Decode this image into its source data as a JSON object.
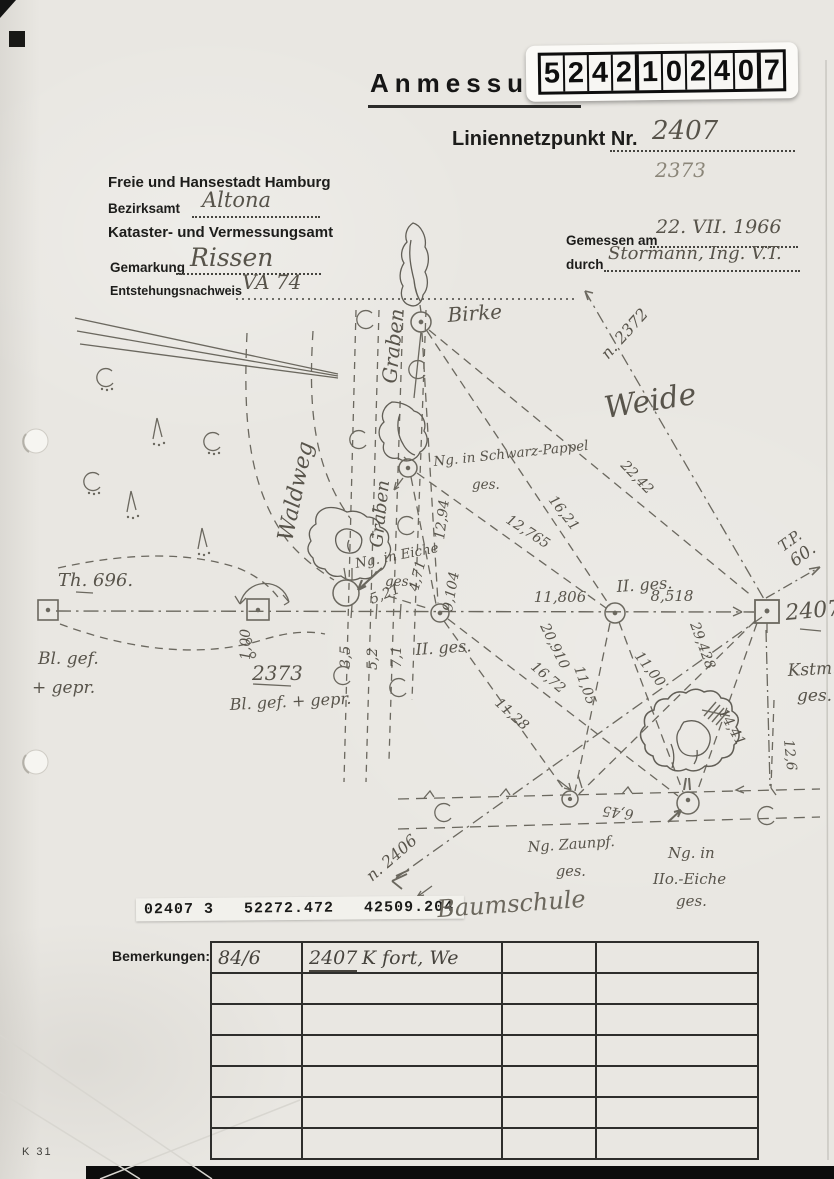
{
  "stamp": {
    "digits": [
      "5",
      "2",
      "4",
      "2",
      "1",
      "0",
      "2",
      "4",
      "0",
      "7"
    ]
  },
  "header": {
    "title": "Anmessung",
    "point_label": "Liniennetzpunkt Nr.",
    "point_number": "2407",
    "point_number_alt": "2373",
    "agency_line1": "Freie und Hansestadt Hamburg",
    "bezirksamt_label": "Bezirksamt",
    "bezirksamt_value": "Altona",
    "agency_line2": "Kataster- und Vermessungsamt",
    "gemarkung_label": "Gemarkung",
    "gemarkung_value": "Rissen",
    "entstehung_label": "Entstehungsnachweis",
    "entstehung_value": "VA 74",
    "gemessen_label": "Gemessen am",
    "gemessen_value": "22. VII. 1966",
    "durch_label": "durch",
    "durch_value": "Stormann, Ing. V.T."
  },
  "sketch": {
    "labels": {
      "birke": "Birke",
      "weide": "Weide",
      "waldweg": "Waldweg",
      "graben": "Graben",
      "baumschule": "Baumschule",
      "schwarzpappel_line1": "Ng. in Schwarz-Pappel",
      "schwarzpappel_line2": "ges.",
      "eiche_line1": "Ng. in Eiche",
      "eiche_line2": "ges.",
      "do_eiche_line1": "Ng. in",
      "do_eiche_line2": "IIo.-Eiche",
      "do_eiche_line3": "ges.",
      "zaunpfahl_line1": "Ng. Zaunpf.",
      "zaunpfahl_line2": "ges.",
      "th696": "Th. 696.",
      "bl_gef_line1": "Bl. gef.",
      "bl_gef_line2": "+ gepr.",
      "p2373": "2373",
      "bl_gef_gepr": "Bl. gef. + gepr.",
      "d_ges": "II. ges.",
      "p2407": "2407",
      "kstm_line1": "Kstm.",
      "kstm_line2": "ges.",
      "tp_line1": "T.P.",
      "tp_line2": "60.",
      "n2372": "n. 2372",
      "n2406": "n. 2406"
    },
    "measurements": {
      "v12_94": "12,94",
      "v4_71": "4,71",
      "v9_104": "9,104",
      "v5_21": "5,21",
      "v12_765": "12,765",
      "v16_21": "16,21",
      "v22_42": "22,42",
      "v11_806": "11,806",
      "v8_518": "8,518",
      "v20_910": "20,910",
      "v16_72": "16,72",
      "v11_05": "11,05",
      "v11_28": "11,28",
      "v11_00": "11,00",
      "v29_428": "29,428",
      "v14_41": "14,41",
      "v12_6": "12,6",
      "v6_45": "6,45",
      "v3_5": "3,5",
      "v5_2": "5,2",
      "v7_1": "7,1",
      "v1_00": "1,00"
    }
  },
  "coordinates": {
    "strip": "02407 3   52272.472   42509.204"
  },
  "remarks": {
    "label": "Bemerkungen:",
    "row1_col1": "84/6",
    "row1_col2_number": "2407",
    "row1_col2_text": "K fort, We"
  },
  "footer": {
    "form_code": "K 31"
  }
}
